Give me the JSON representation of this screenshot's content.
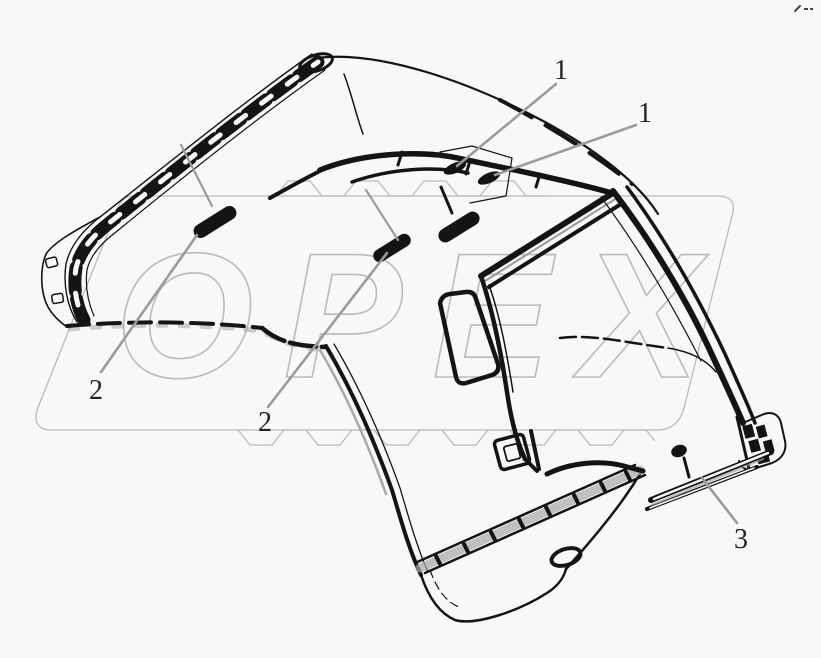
{
  "diagram": {
    "background_color": "#f8f8f8",
    "line_color": "#141414",
    "leader_color": "#9b9b9b",
    "label_color": "#222222",
    "description_type": "vehicle-cab-parts-line-drawing",
    "callouts": [
      {
        "id": "callout-1-left",
        "label": "1"
      },
      {
        "id": "callout-1-right",
        "label": "1"
      },
      {
        "id": "callout-2-left",
        "label": "2"
      },
      {
        "id": "callout-2-mid",
        "label": "2"
      },
      {
        "id": "callout-3",
        "label": "3"
      }
    ],
    "watermark": {
      "text": "OPEX",
      "color": "#7d7d7d",
      "opacity": 0.5
    },
    "icons": {
      "corner_mark": "squiggle-dash-mark"
    }
  }
}
